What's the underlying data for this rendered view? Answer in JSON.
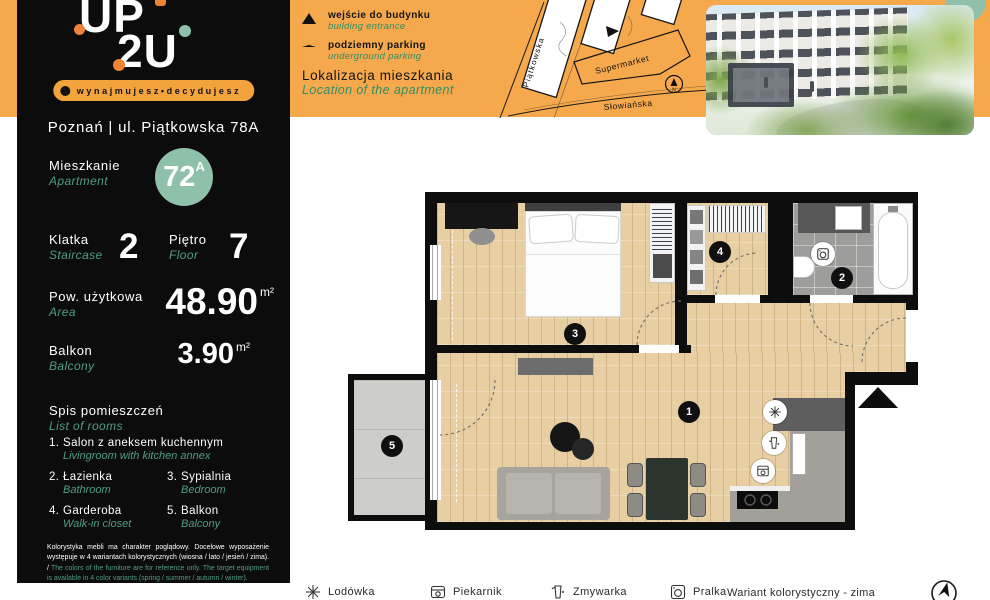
{
  "brand": {
    "line1": "UP",
    "line2": "2U",
    "tagline": "wynajmujesz•decydujesz"
  },
  "address": "Poznań | ul. Piątkowska 78A",
  "info": {
    "apartment": {
      "pl": "Mieszkanie",
      "en": "Apartment",
      "number": "72",
      "suffix": "A"
    },
    "staircase": {
      "pl": "Klatka",
      "en": "Staircase",
      "value": "2"
    },
    "floor": {
      "pl": "Piętro",
      "en": "Floor",
      "value": "7"
    },
    "area": {
      "pl": "Pow. użytkowa",
      "en": "Area",
      "value": "48.90",
      "unit": "m²"
    },
    "balcony": {
      "pl": "Balkon",
      "en": "Balcony",
      "value": "3.90",
      "unit": "m²"
    }
  },
  "rooms": {
    "pl": "Spis pomieszczeń",
    "en": "List of rooms",
    "items": [
      {
        "num": "1.",
        "pl": "Salon z aneksem kuchennym",
        "en": "Livingroom with kitchen annex"
      },
      {
        "num": "2.",
        "pl": "Łazienka",
        "en": "Bathroom"
      },
      {
        "num": "3.",
        "pl": "Sypialnia",
        "en": "Bedroom"
      },
      {
        "num": "4.",
        "pl": "Garderoba",
        "en": "Walk-in closet"
      },
      {
        "num": "5.",
        "pl": "Balkon",
        "en": "Balcony"
      }
    ]
  },
  "disclaimer": {
    "pl": "Kolorystyka mebli ma charakter poglądowy. Docelowe wyposażenie występuje w 4 wariantach kolorystycznych (wiosna / lato / jesień / zima). / ",
    "en": "The colors of the furniture are for reference only. The target equipment is available in 4 color variants (spring / summer / autumn / winter)."
  },
  "legend": {
    "entrance": {
      "pl": "wejście do budynku",
      "en": "building entrance"
    },
    "parking": {
      "pl": "podziemny parking",
      "en": "underground parking"
    },
    "location": {
      "pl": "Lokalizacja mieszkania",
      "en": "Location of the apartment"
    }
  },
  "map": {
    "street_side": "Piątkowska",
    "street_bottom": "Słowiańska",
    "supermarket": "Supermarket",
    "compass_n": "N"
  },
  "plan": {
    "badges": {
      "living": "1",
      "bath": "2",
      "bedroom": "3",
      "closet": "4",
      "balcony": "5"
    }
  },
  "footer": {
    "appliances": [
      {
        "name": "fridge",
        "label": "Lodówka"
      },
      {
        "name": "oven",
        "label": "Piekarnik"
      },
      {
        "name": "dishwasher",
        "label": "Zmywarka"
      },
      {
        "name": "washer",
        "label": "Pralka"
      }
    ],
    "variant": "Wariant kolorystyczny - zima"
  },
  "colors": {
    "orange": "#F6A94C",
    "green_accent": "#4E9E80",
    "sage": "#8FC0AA",
    "sidebar": "#0C0C0C"
  }
}
